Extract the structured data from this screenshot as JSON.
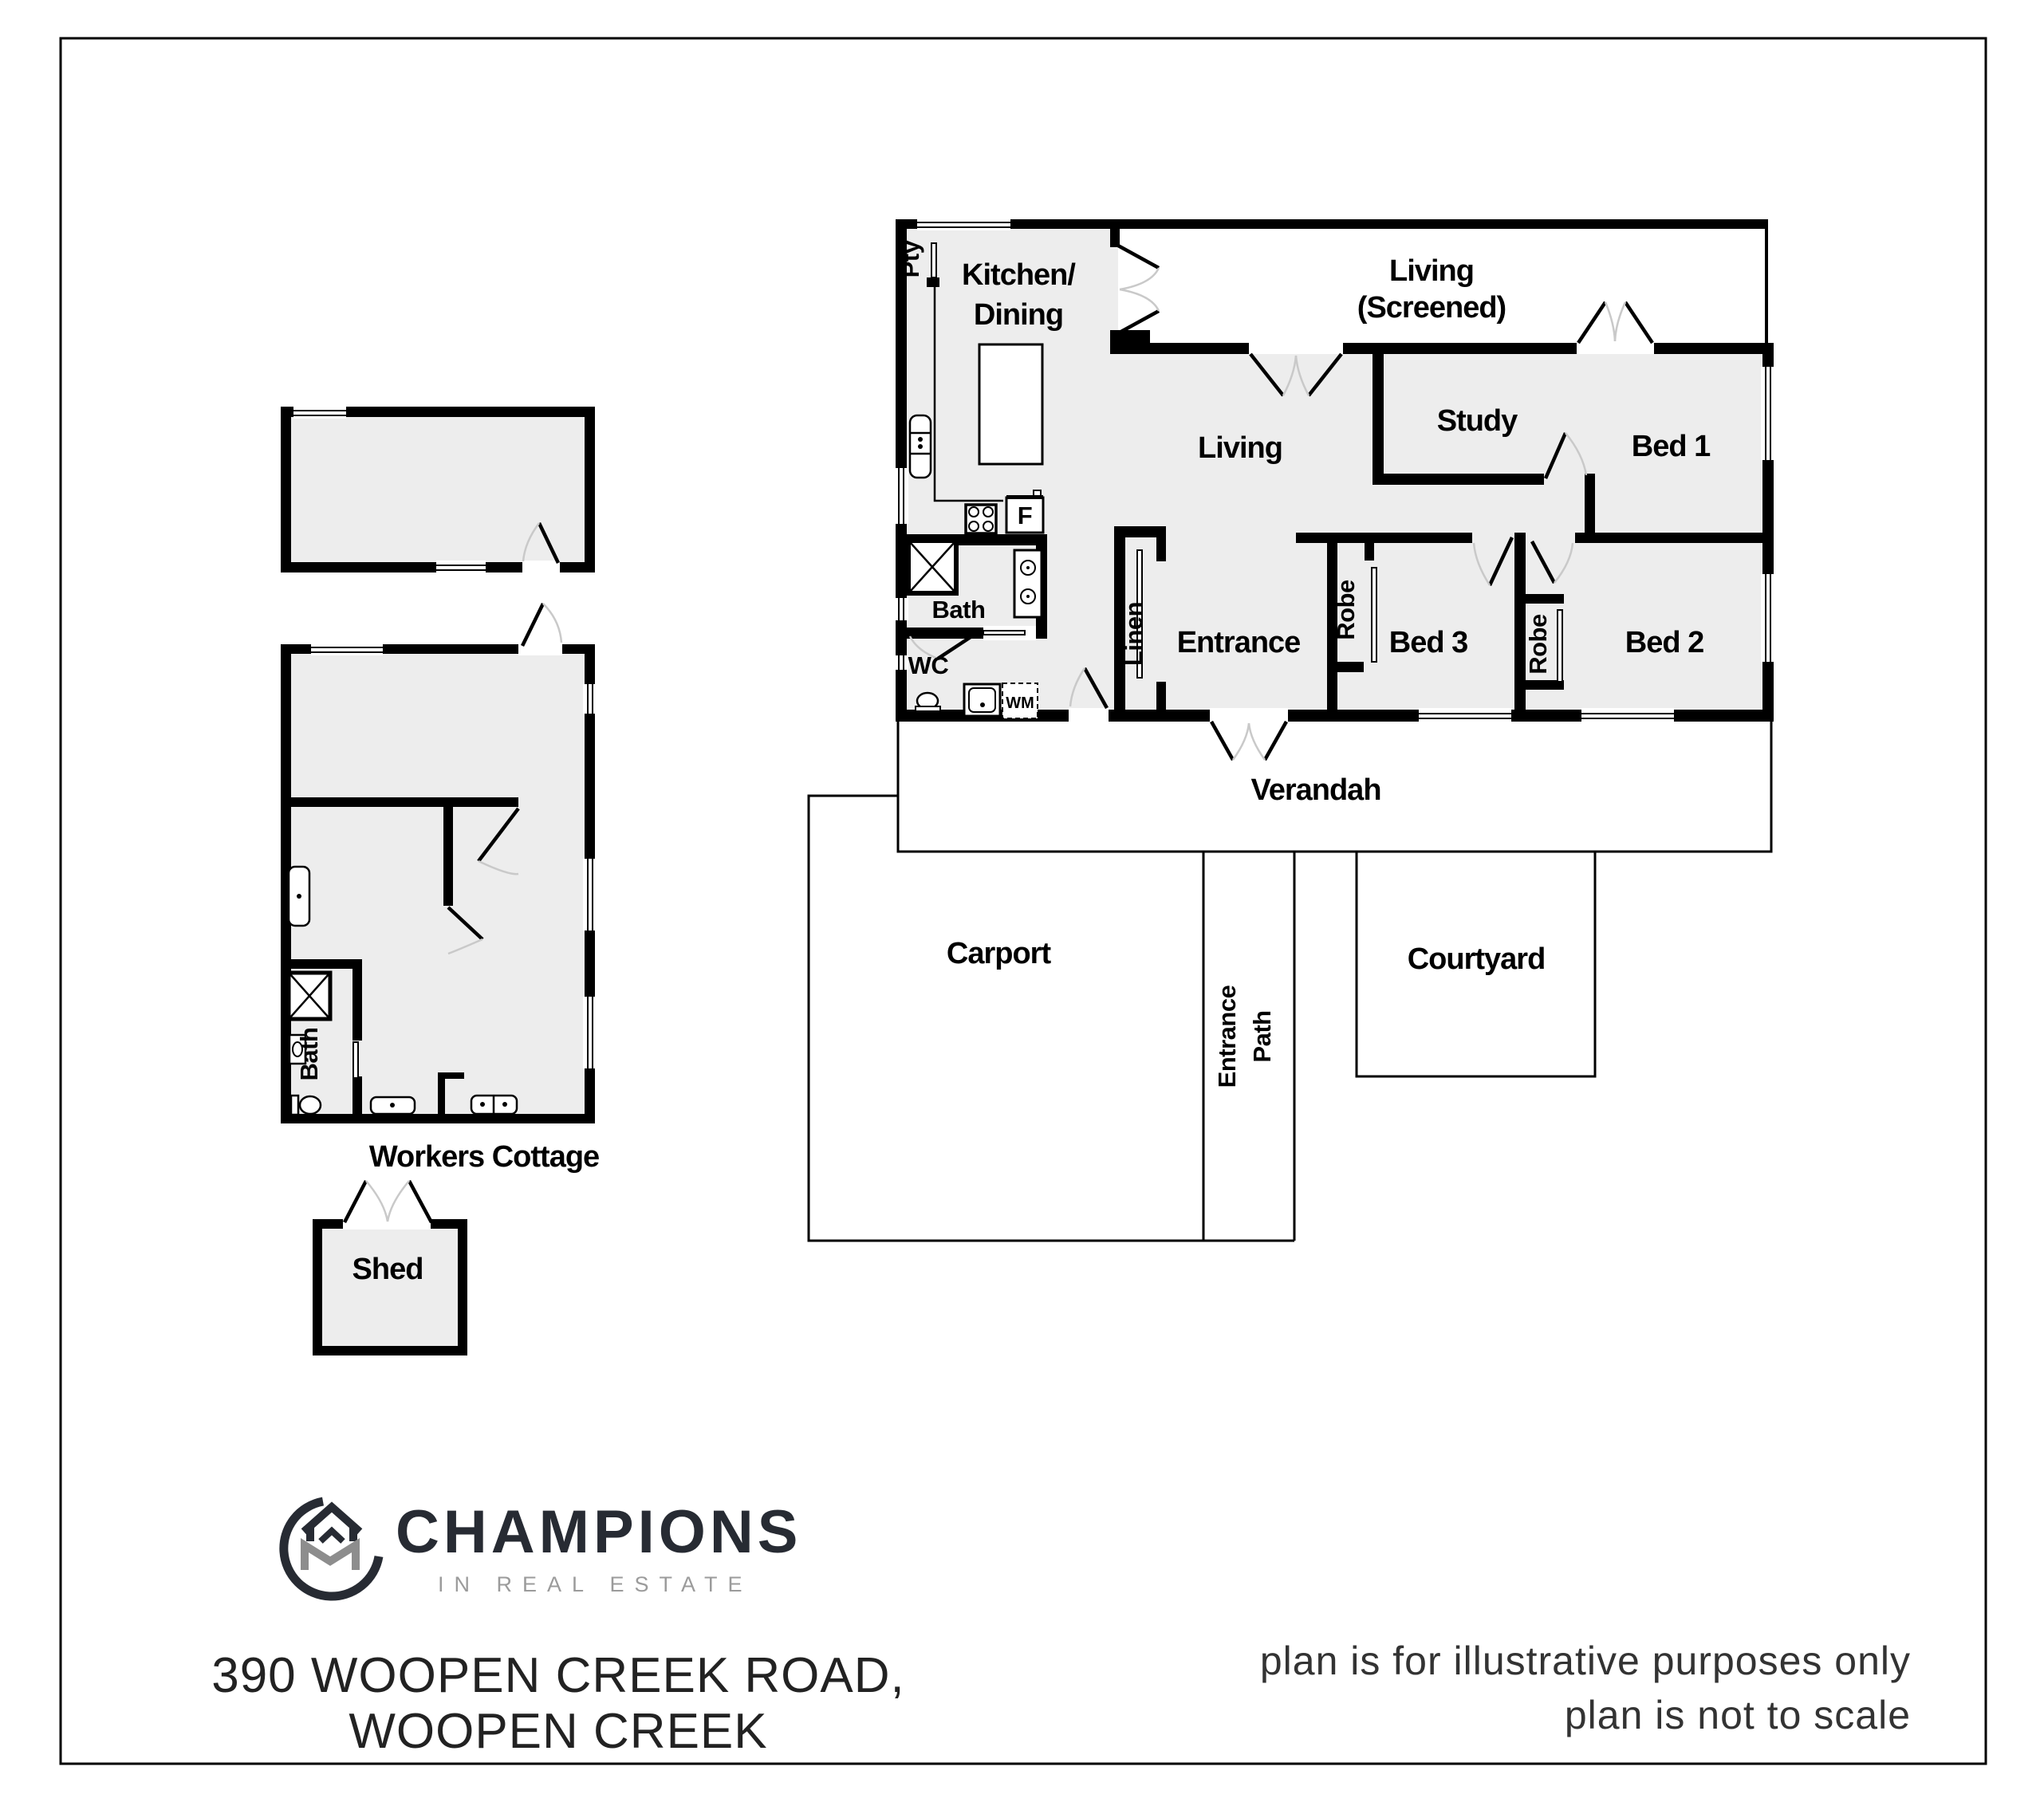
{
  "labels": {
    "pty": "Pty",
    "kitchen_line1": "Kitchen/",
    "kitchen_line2": "Dining",
    "living_screened_line1": "Living",
    "living_screened_line2": "(Screened)",
    "living": "Living",
    "study": "Study",
    "bed1": "Bed 1",
    "fridge": "F",
    "bath": "Bath",
    "wc": "WC",
    "wm": "WM",
    "linen": "Linen",
    "entrance": "Entrance",
    "robe_bed3": "Robe",
    "bed3": "Bed 3",
    "robe_bed2": "Robe",
    "bed2": "Bed 2",
    "verandah": "Verandah",
    "carport": "Carport",
    "entrance_path_line1": "Entrance",
    "entrance_path_line2": "Path",
    "courtyard": "Courtyard"
  },
  "cottage": {
    "bath": "Bath",
    "title": "Workers Cottage"
  },
  "shed": {
    "title": "Shed"
  },
  "branding": {
    "name": "CHAMPIONS",
    "tagline": "IN REAL ESTATE"
  },
  "address": {
    "line1": "390 WOOPEN CREEK ROAD,",
    "line2": "WOOPEN CREEK"
  },
  "disclaimer": {
    "line1": "plan is for illustrative purposes only",
    "line2": "plan is not to scale"
  },
  "colors": {
    "wall": "#000000",
    "floor": "#ededed",
    "arc": "#c9c9c9",
    "logo_dark": "#272b33",
    "logo_gray": "#8d8d8d",
    "tagline_gray": "#9b9b9b",
    "address": "#222222",
    "disclaimer": "#333333",
    "bg": "#ffffff"
  }
}
